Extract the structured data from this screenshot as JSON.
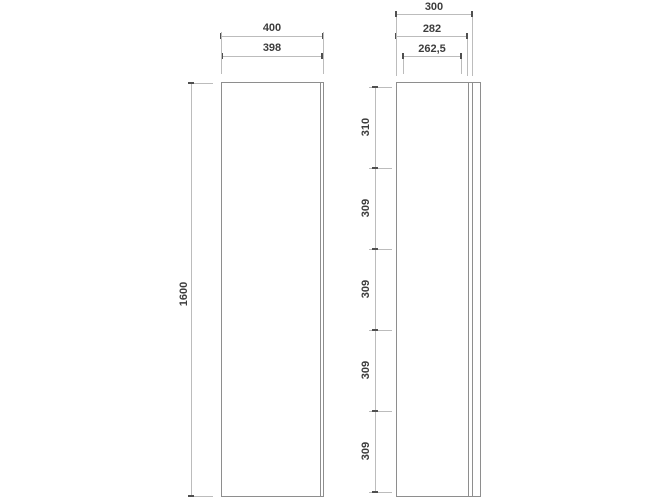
{
  "front_view": {
    "width_dim": "400",
    "door_width_dim": "398",
    "height_dim": "1600"
  },
  "side_view": {
    "depth_dim": "300",
    "body_depth_dim": "282",
    "inner_depth_dim": "262,5",
    "shelf_spacing_dims": [
      "310",
      "309",
      "309",
      "309",
      "309"
    ]
  },
  "colors": {
    "background": "#ffffff",
    "object_line": "#8e8e8e",
    "dimension_line": "#bcbcbc",
    "terminator": "#4f4f4f",
    "text": "#3d3d3d"
  }
}
